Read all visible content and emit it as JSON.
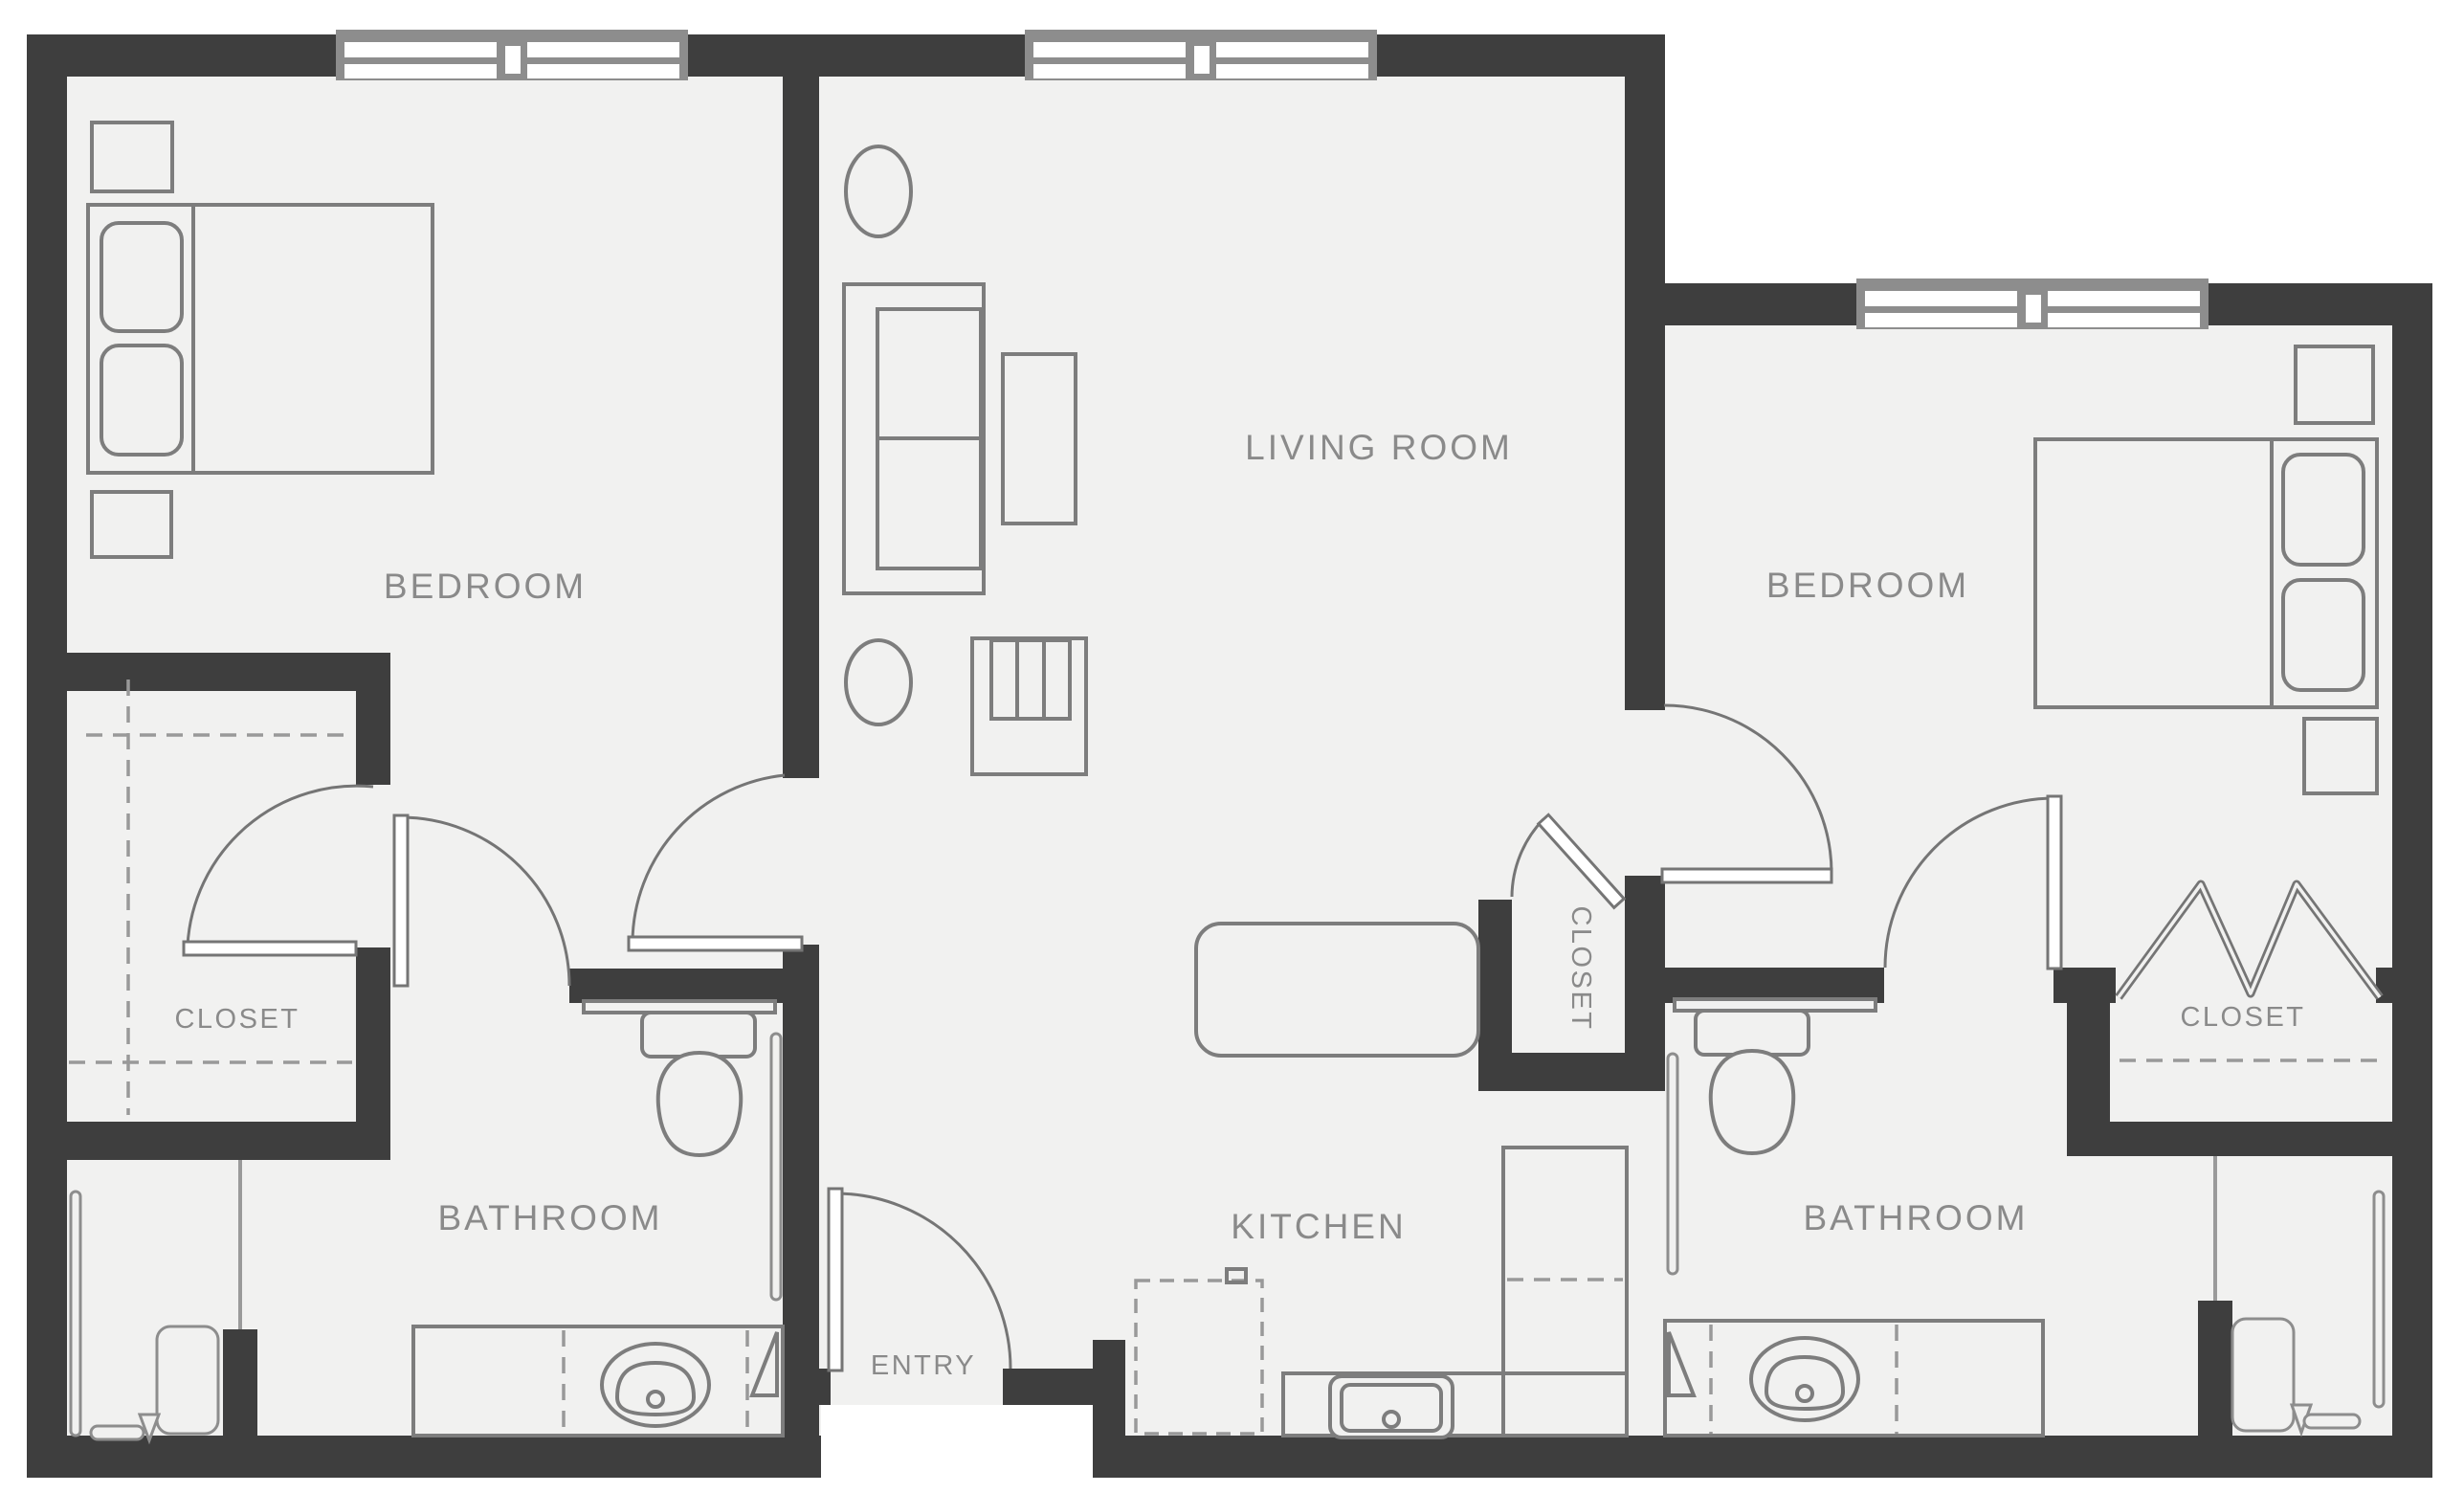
{
  "title": "Two bedroom two bathroom apartment floor plan",
  "rooms": {
    "bedroom_left": {
      "label": "BEDROOM"
    },
    "living_room": {
      "label": "LIVING ROOM"
    },
    "bedroom_right": {
      "label": "BEDROOM"
    },
    "closet_left": {
      "label": "CLOSET"
    },
    "closet_middle": {
      "label": "CLOSET"
    },
    "closet_right": {
      "label": "CLOSET"
    },
    "bathroom_left": {
      "label": "BATHROOM"
    },
    "bathroom_right": {
      "label": "BATHROOM"
    },
    "kitchen": {
      "label": "KITCHEN"
    },
    "entry": {
      "label": "ENTRY"
    }
  },
  "colors": {
    "wall": "#3e3e3e",
    "floor": "#f1f1f0",
    "furniture_line": "#7d7d7d",
    "door_line": "#757575",
    "dashed_line": "#999999",
    "label_text": "#8a8a8a",
    "window_frame": "#8d8d8d",
    "background": "#ffffff"
  },
  "fixtures": [
    "bed-left",
    "bed-right",
    "nightstands",
    "sofa",
    "side-tables",
    "coffee-table",
    "tv-console",
    "kitchen-island",
    "kitchen-sink",
    "range-dashed",
    "counters",
    "toilets",
    "vanity-sinks",
    "showers",
    "bifold-closet-doors",
    "hinged-doors",
    "windows"
  ],
  "window_count": 3,
  "door_count": 8
}
